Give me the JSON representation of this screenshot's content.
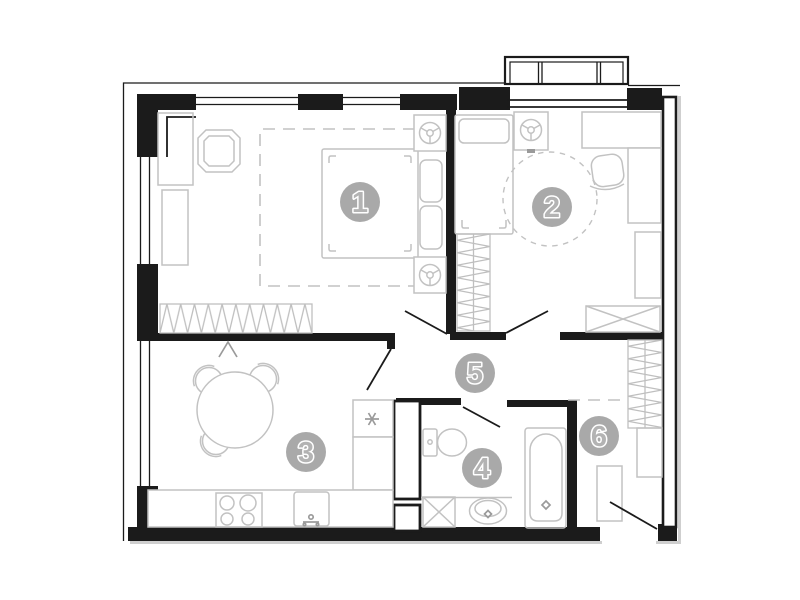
{
  "meta": {
    "title": "Apartment floor plan",
    "kind": "architectural-floor-plan"
  },
  "colors": {
    "background": "#ffffff",
    "wall": "#1b1b1b",
    "furniture": "#c2c2c2",
    "hatch": "#bfbfbf",
    "shadow": "#cfcfcf",
    "mark": "#9a9a9a",
    "label_bg": "#a9a9a9",
    "label_glyph": "#b3b3b3"
  },
  "label_radius": 20,
  "room_labels": [
    {
      "label": "1",
      "cx": 360,
      "cy": 202
    },
    {
      "label": "2",
      "cx": 552,
      "cy": 207
    },
    {
      "label": "3",
      "cx": 306,
      "cy": 452
    },
    {
      "label": "4",
      "cx": 482,
      "cy": 468
    },
    {
      "label": "5",
      "cx": 475,
      "cy": 373
    },
    {
      "label": "6",
      "cx": 599,
      "cy": 436
    }
  ]
}
